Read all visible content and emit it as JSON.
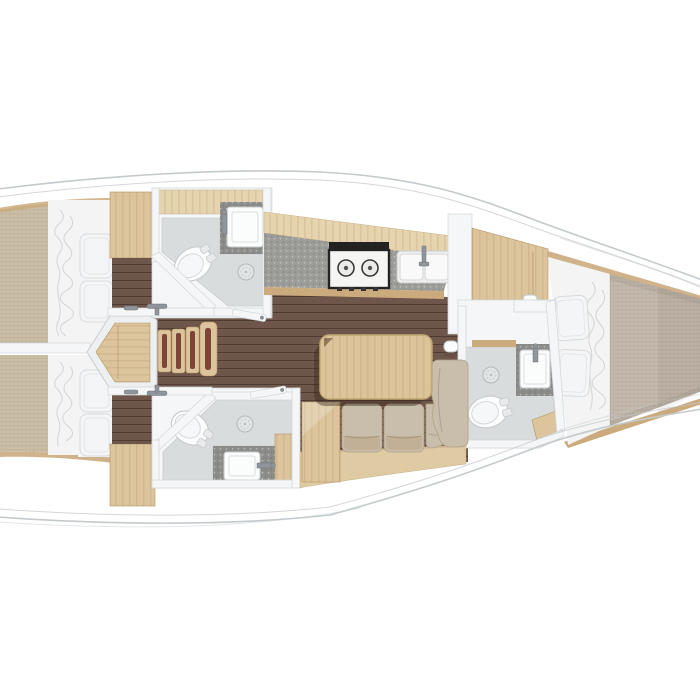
{
  "title": "sailing-yacht-interior-floor-plan",
  "colors": {
    "background": "#ffffff",
    "hull_line": "#c4c9cc",
    "deck": "#ffffff",
    "wall": "#f4f6f7",
    "wall_edge": "#d3d7d9",
    "wood_light": "#dcc59d",
    "wood_pale": "#e5d4ae",
    "wood_mid": "#cbab7d",
    "wood_grain": "#b6935f",
    "floor_dark": "#6f564a",
    "counter_gray": "#9c9c98",
    "counter_dark": "#8c8c8a",
    "bath_floor": "#d9dcdc",
    "mattress_beige": "#cbbea7",
    "vberth_beige": "#c3b9ac",
    "linen_white": "#f3f4f3",
    "cushion_beige": "#c9bdab",
    "cushion_seat": "#c2b096",
    "cushion_shade": "#b0a288",
    "pillow_white": "#f4f5f6",
    "pillow_edge": "#d8dbdd",
    "fixture_white": "#fbfcfc",
    "fixture_edge": "#c6cacc",
    "steel": "#8f959a",
    "stove_frame": "#202020",
    "step_stripe": "#7e4536"
  },
  "semantics": {
    "rooms": [
      "aft-cabin-port",
      "aft-cabin-starboard",
      "aft-head",
      "day-head",
      "galley",
      "saloon",
      "forward-head",
      "forward-cabin",
      "companionway"
    ],
    "fixtures": [
      "toilet",
      "washbasin",
      "shower-drain",
      "two-burner-stove",
      "double-sink",
      "dining-table",
      "l-shaped-sofa",
      "v-berth",
      "companionway-steps",
      "door-handle",
      "grab-pole"
    ]
  }
}
